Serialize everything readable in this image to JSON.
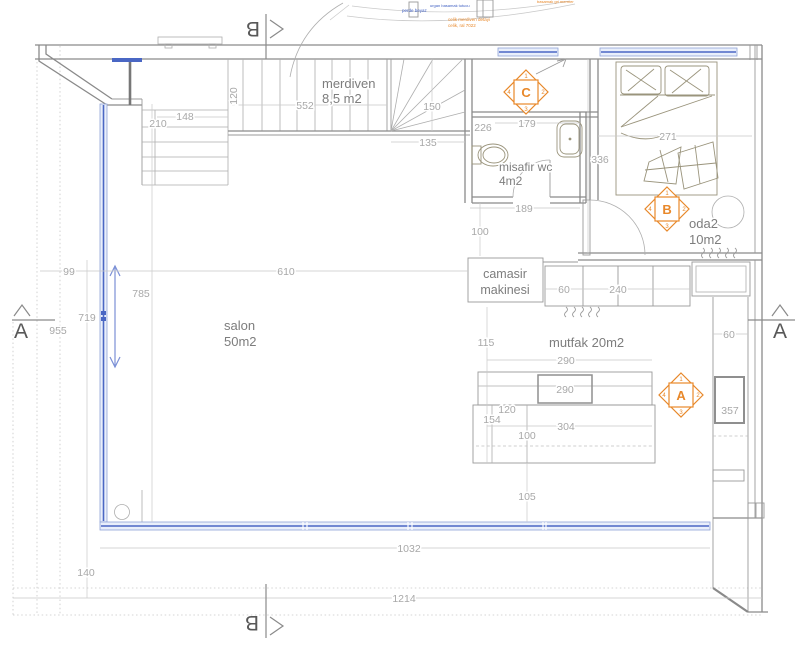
{
  "colors": {
    "wall_line": "#8a8a8a",
    "dim_text": "#a8a8a8",
    "label_text": "#7d7d7d",
    "window_blue": "#8fa3d8",
    "window_blue_dark": "#4a67c4",
    "accent_orange": "#e8882a",
    "annotation_blue": "#3f5fc2"
  },
  "rooms": {
    "merdiven": {
      "name": "merdiven",
      "area": "8,5 m2"
    },
    "misafir_wc": {
      "name": "misafir wc",
      "area": "4m2"
    },
    "salon": {
      "name": "salon",
      "area": "50m2"
    },
    "oda2": {
      "name": "oda2",
      "area": "10m2"
    },
    "mutfak": {
      "label": "mutfak 20m2"
    },
    "camasir": {
      "line1": "camasir",
      "line2": "makinesi"
    }
  },
  "markers": {
    "section_a": "A",
    "section_b": "B",
    "detail_a": "A",
    "detail_b": "B",
    "detail_c": "C",
    "ticks": [
      "1",
      "2",
      "3",
      "4"
    ]
  },
  "annotations": {
    "note1": "basamak gri mermer",
    "note2": "urgan basamak tutucu",
    "note3": "perde beyaz",
    "note4": "celik merdiven detayi",
    "note5": "celik, ral 7022"
  },
  "dims": {
    "d120": "120",
    "d148": "148",
    "d210": "210",
    "d552": "552",
    "d150": "150",
    "d135": "135",
    "d226": "226",
    "d179": "179",
    "d189": "189",
    "d100_hall": "100",
    "d336": "336",
    "d271": "271",
    "d99": "99",
    "d610": "610",
    "d785": "785",
    "d719": "719",
    "d955": "955",
    "d60_counter": "60",
    "d240": "240",
    "d115": "115",
    "d290_line": "290",
    "d290_island": "290",
    "d120_island": "120",
    "d154": "154",
    "d304": "304",
    "d100_island": "100",
    "d105": "105",
    "d60_right": "60",
    "d357": "357",
    "d1032": "1032",
    "d140": "140",
    "d1214": "1214"
  }
}
